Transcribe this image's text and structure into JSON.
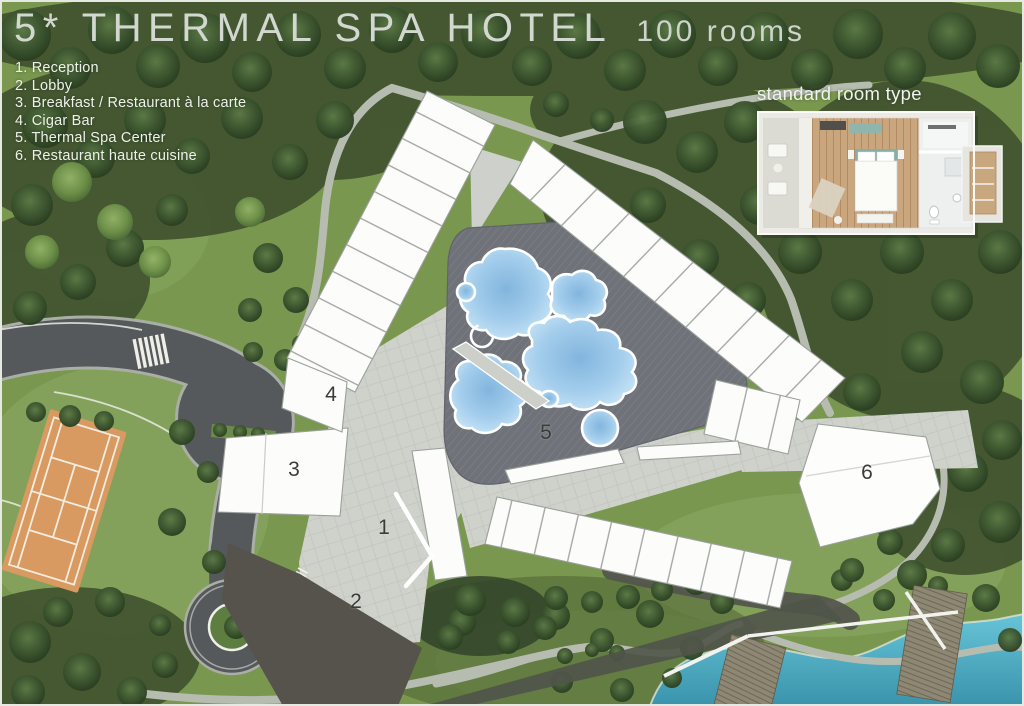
{
  "header": {
    "title": "5* THERMAL SPA HOTEL",
    "subtitle": "100 rooms"
  },
  "legend": {
    "items": [
      {
        "number": "1",
        "label": "Reception",
        "text": "1. Reception"
      },
      {
        "number": "2",
        "label": "Lobby",
        "text": "2. Lobby"
      },
      {
        "number": "3",
        "label": "Breakfast / Restaurant à la carte",
        "text": "3. Breakfast / Restaurant à la carte"
      },
      {
        "number": "4",
        "label": "Cigar Bar",
        "text": "4. Cigar Bar"
      },
      {
        "number": "5",
        "label": "Thermal Spa Center",
        "text": "5. Thermal Spa Center"
      },
      {
        "number": "6",
        "label": "Restaurant haute cuisine",
        "text": "6. Restaurant haute cuisine"
      }
    ]
  },
  "inset": {
    "label": "standard room type"
  },
  "palette": {
    "forest": "#3f5130",
    "grass": "#79974f",
    "road": "#56595b",
    "paving": "#cfd2cb",
    "spa_deck": "#6f7379",
    "pool_water": "#a3cdec",
    "lake": "#4fb0c8",
    "tennis_court": "#d89a60",
    "building": "#fcfcfa"
  }
}
